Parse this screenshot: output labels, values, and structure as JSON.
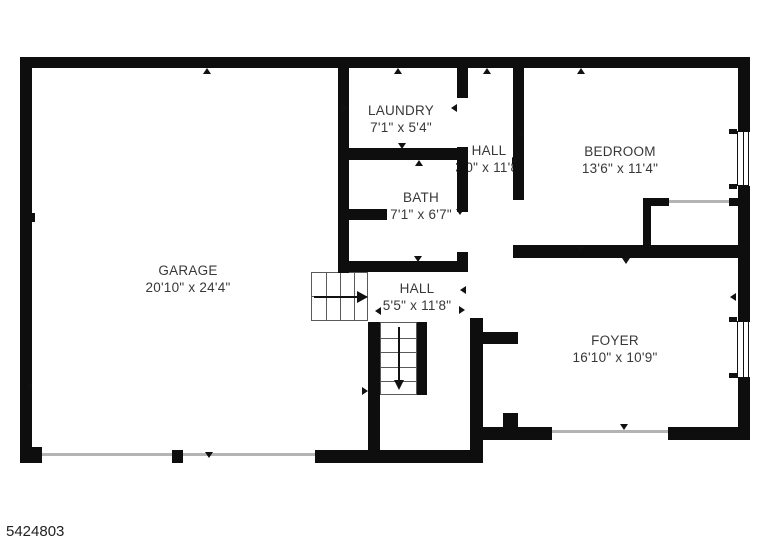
{
  "floorplan": {
    "ref_number": "5424803",
    "rooms": {
      "garage": {
        "name": "GARAGE",
        "dims": "20'10\" x 24'4\""
      },
      "laundry": {
        "name": "LAUNDRY",
        "dims": "7'1\" x 5'4\""
      },
      "bath": {
        "name": "BATH",
        "dims": "7'1\" x 6'7\""
      },
      "hall_upper": {
        "name": "HALL",
        "dims": "3'0\" x 11'8\""
      },
      "bedroom": {
        "name": "BEDROOM",
        "dims": "13'6\" x 11'4\""
      },
      "hall_lower": {
        "name": "HALL",
        "dims": "5'5\" x 11'8\""
      },
      "foyer": {
        "name": "FOYER",
        "dims": "16'10\" x 10'9\""
      }
    },
    "colors": {
      "wall": "#0e0e0e",
      "text": "#383838",
      "thin_line": "#b4b4b4"
    }
  }
}
